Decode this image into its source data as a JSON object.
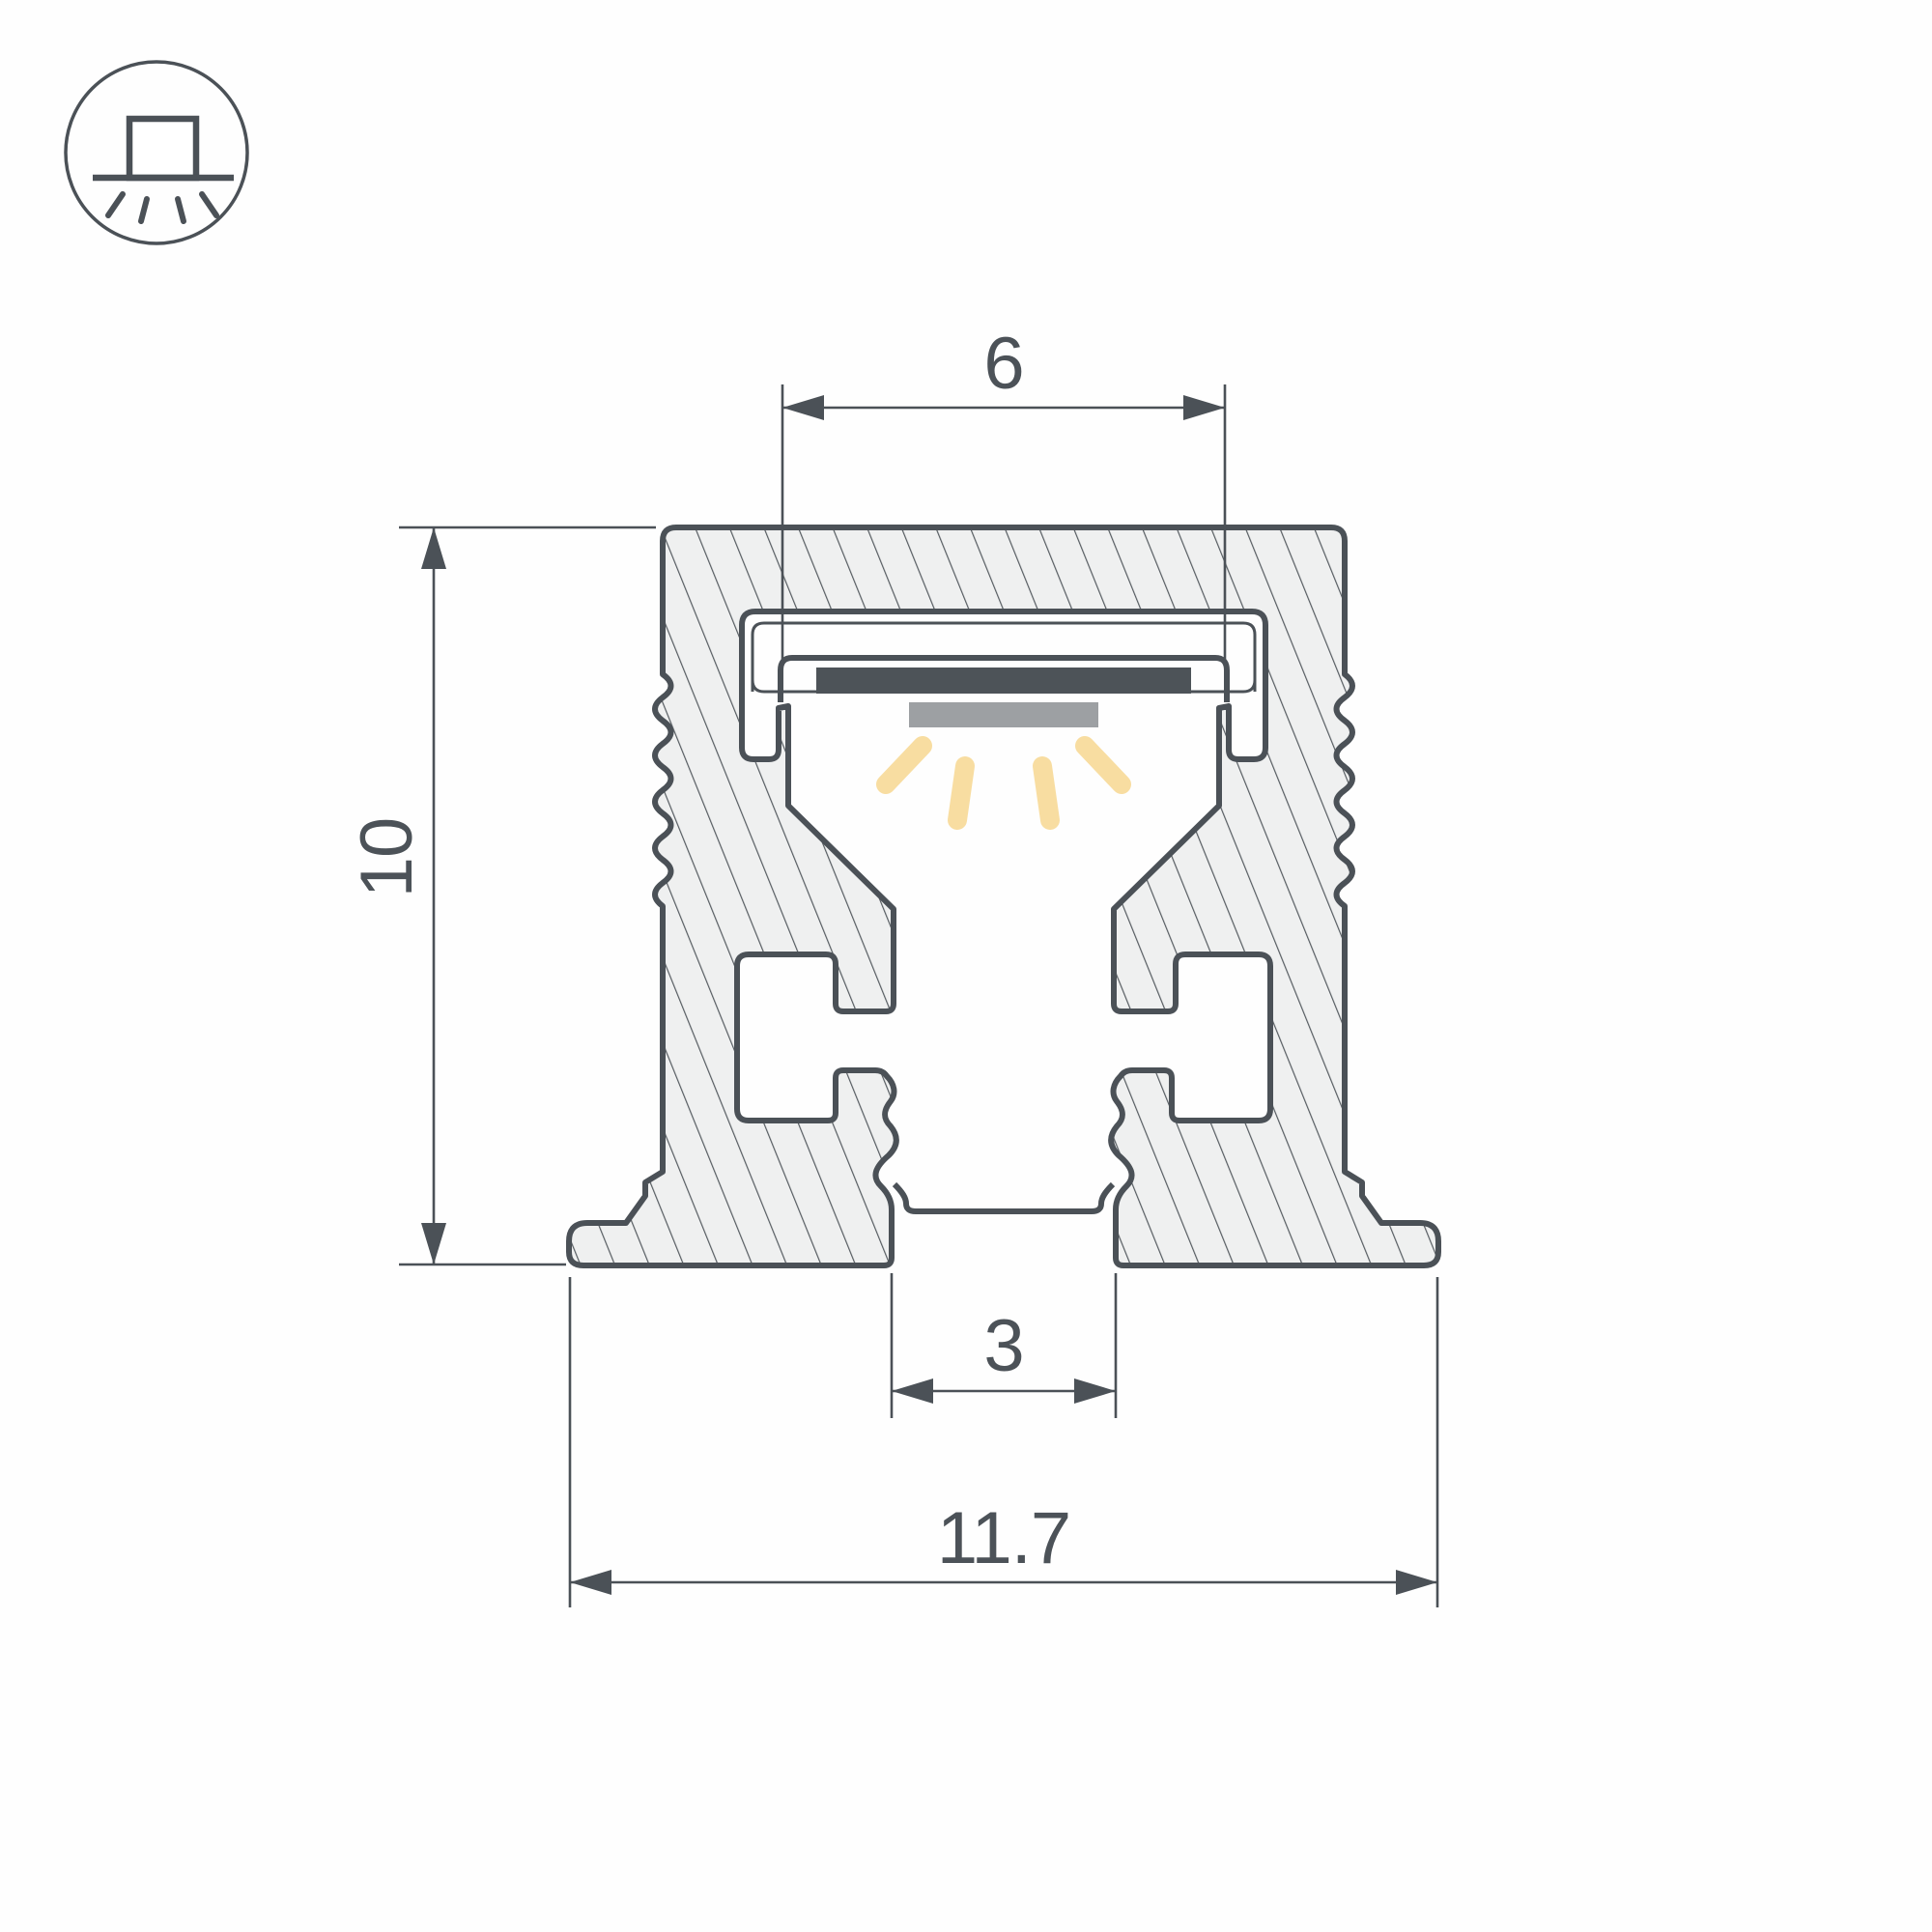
{
  "title": "LED aluminium profile cross-section drawing",
  "icon": {
    "name": "surface-mount-downlight-icon",
    "description": "fixture on surface emitting light downward"
  },
  "dimensions": {
    "slot_width": {
      "label": "6"
    },
    "height": {
      "label": "10"
    },
    "bottom_slot": {
      "label": "3"
    },
    "overall_width": {
      "label": "11.7"
    }
  },
  "colors": {
    "line": "#4b5157",
    "hatch_fill": "#eff0f0",
    "hatch_line": "#565c61",
    "led_pcb": "#4d5358",
    "led_tape": "#9da0a3",
    "light_ray": "#f8dda1",
    "background": "#ffffff"
  }
}
